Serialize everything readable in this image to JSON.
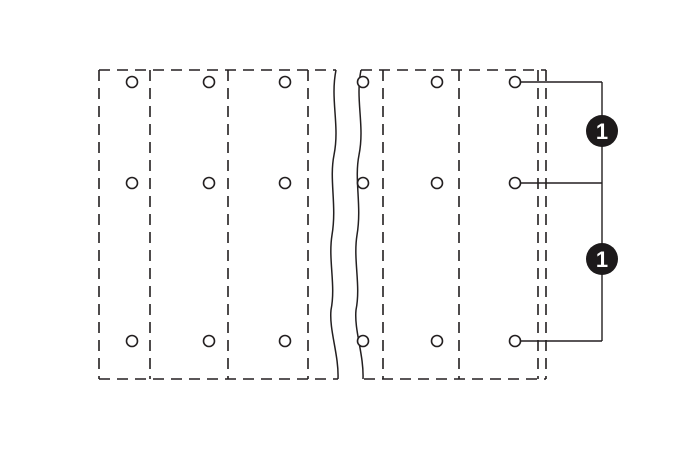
{
  "canvas": {
    "width": 697,
    "height": 449,
    "background": "#ffffff",
    "line_color": "#231f20",
    "badge_fill": "#1d1a1b",
    "badge_label_color": "#ffffff"
  },
  "diagram": {
    "type": "terminal-block-drilling-plan",
    "outline": {
      "left": 99,
      "top": 70,
      "right": 546,
      "bottom": 379
    },
    "break_region": {
      "x1": 333,
      "x2": 358
    },
    "divider_lines_x": [
      150,
      228,
      308,
      383,
      459,
      538
    ],
    "holes": {
      "columns_x": [
        132,
        209,
        285,
        363,
        437,
        515
      ],
      "rows_y": [
        82,
        183,
        341
      ],
      "radius": 5.5
    },
    "callouts": {
      "leader_line_x": 602,
      "leader_rows_y": [
        82,
        183,
        341
      ],
      "badge_radius": 16,
      "badges": [
        {
          "label": "1",
          "y": 131
        },
        {
          "label": "1",
          "y": 259
        }
      ]
    }
  }
}
